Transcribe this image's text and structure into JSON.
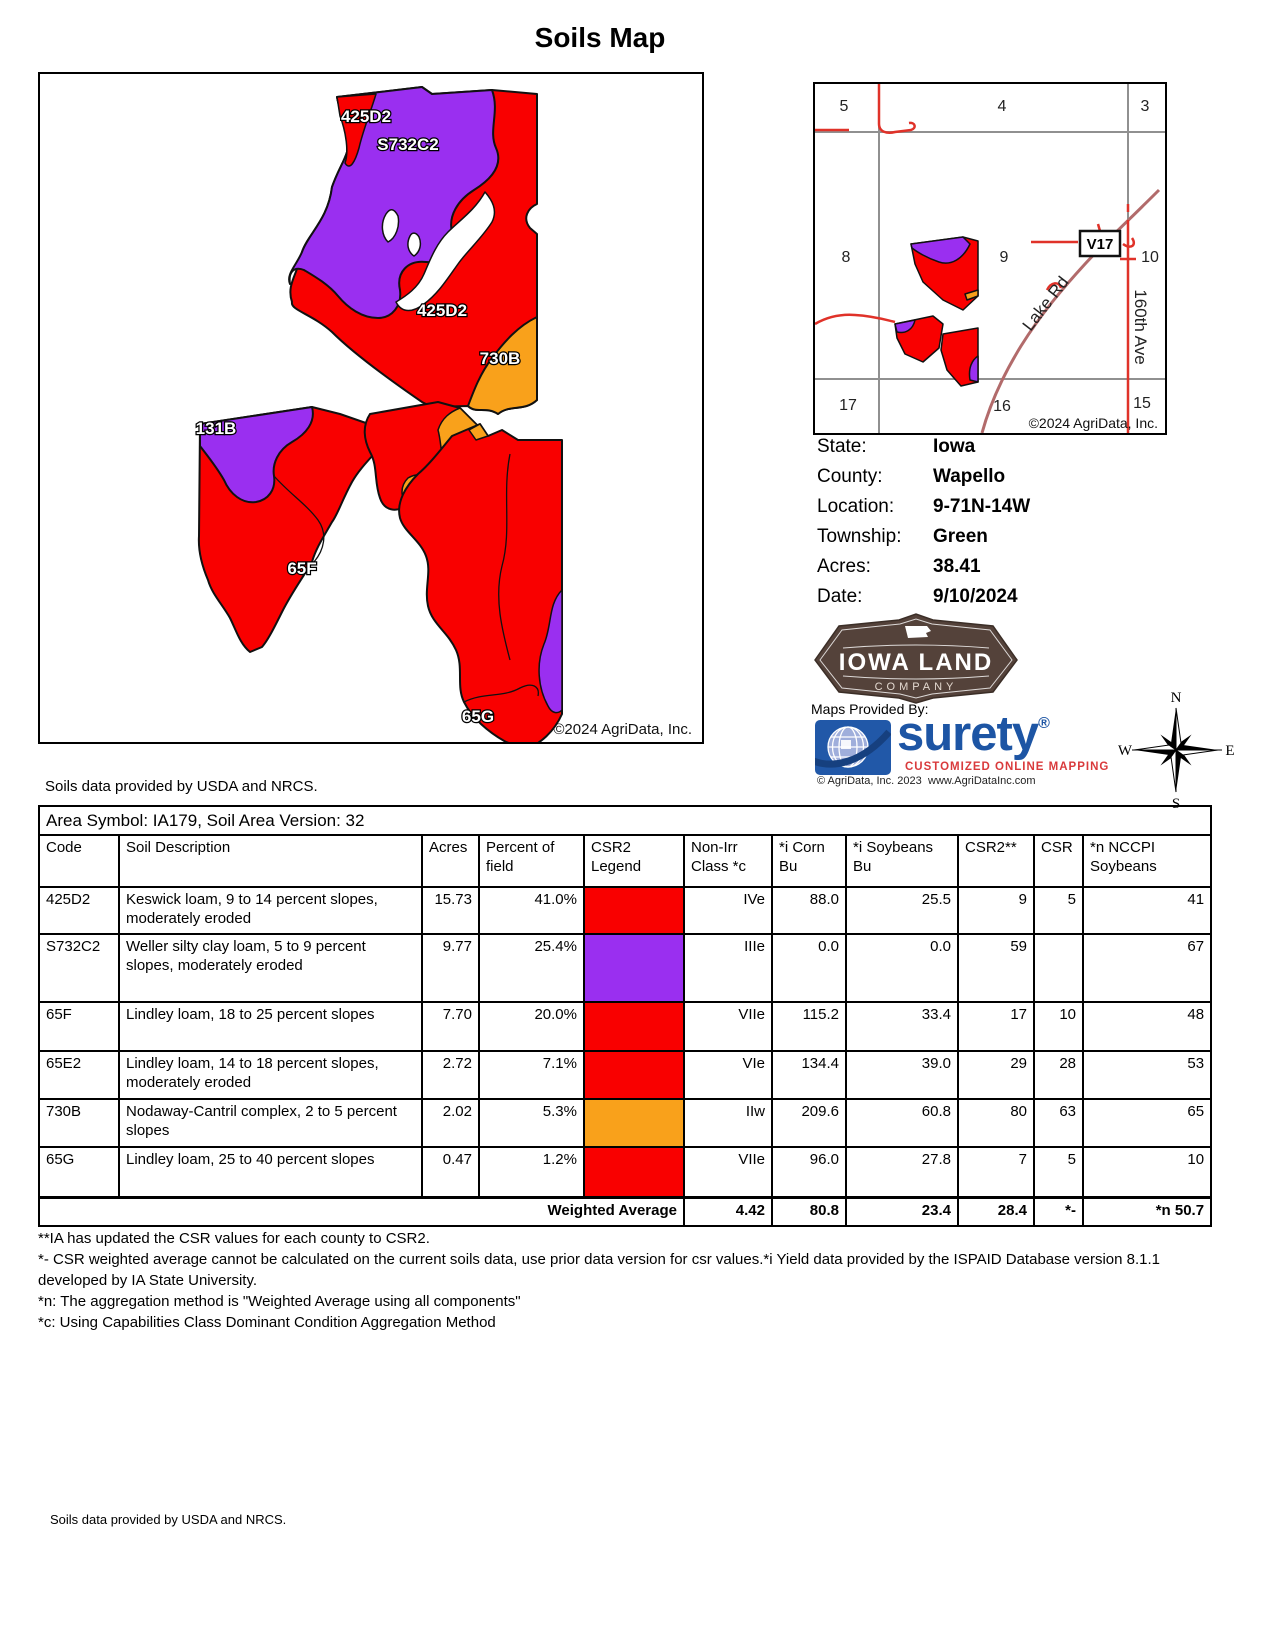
{
  "title": "Soils Map",
  "colors": {
    "soil_red": "#F90000",
    "soil_purple": "#9A2FF0",
    "soil_orange": "#F9A11B"
  },
  "map": {
    "labels": [
      "425D2",
      "S732C2",
      "425D2",
      "730B",
      "131B",
      "65F",
      "65G"
    ],
    "copyright": "©2024 AgriData, Inc.",
    "note": "Soils data provided by USDA and NRCS."
  },
  "locator": {
    "sections": [
      "5",
      "4",
      "3",
      "8",
      "9",
      "10",
      "17",
      "16",
      "15"
    ],
    "badge": "V17",
    "road_lake": "Lake Rd",
    "road_160th": "160th Ave",
    "copyright": "©2024 AgriData, Inc."
  },
  "info": {
    "rows": [
      {
        "label": "State:",
        "value": "Iowa"
      },
      {
        "label": "County:",
        "value": "Wapello"
      },
      {
        "label": "Location:",
        "value": "9-71N-14W"
      },
      {
        "label": "Township:",
        "value": "Green"
      },
      {
        "label": "Acres:",
        "value": "38.41"
      },
      {
        "label": "Date:",
        "value": "9/10/2024"
      }
    ]
  },
  "branding": {
    "iowa_land_line1": "IOWA LAND",
    "iowa_land_line2": "COMPANY",
    "provided_by": "Maps Provided By:",
    "surety": "surety",
    "surety_reg": "®",
    "surety_tagline": "CUSTOMIZED ONLINE MAPPING",
    "surety_copyright": "© AgriData, Inc. 2023",
    "surety_url": "www.AgriDataInc.com"
  },
  "compass": {
    "n": "N",
    "e": "E",
    "s": "S",
    "w": "W"
  },
  "table": {
    "area_title": "Area Symbol: IA179, Soil Area Version: 32",
    "headers": [
      "Code",
      "Soil Description",
      "Acres",
      "Percent of field",
      "CSR2 Legend",
      "Non-Irr Class *c",
      "*i Corn Bu",
      "*i Soybeans Bu",
      "CSR2**",
      "CSR",
      "*n NCCPI Soybeans"
    ],
    "rows": [
      {
        "code": "425D2",
        "desc": "Keswick loam, 9 to 14 percent slopes, moderately eroded",
        "acres": "15.73",
        "pct": "41.0%",
        "color": "#F90000",
        "cls": "IVe",
        "corn": "88.0",
        "soy": "25.5",
        "csr2": "9",
        "csr": "5",
        "nccpi": "41"
      },
      {
        "code": "S732C2",
        "desc": "Weller silty clay loam, 5 to 9 percent slopes, moderately eroded",
        "acres": "9.77",
        "pct": "25.4%",
        "color": "#9A2FF0",
        "cls": "IIIe",
        "corn": "0.0",
        "soy": "0.0",
        "csr2": "59",
        "csr": "",
        "nccpi": "67"
      },
      {
        "code": "65F",
        "desc": "Lindley loam, 18 to 25 percent slopes",
        "acres": "7.70",
        "pct": "20.0%",
        "color": "#F90000",
        "cls": "VIIe",
        "corn": "115.2",
        "soy": "33.4",
        "csr2": "17",
        "csr": "10",
        "nccpi": "48"
      },
      {
        "code": "65E2",
        "desc": "Lindley loam, 14 to 18 percent slopes, moderately eroded",
        "acres": "2.72",
        "pct": "7.1%",
        "color": "#F90000",
        "cls": "VIe",
        "corn": "134.4",
        "soy": "39.0",
        "csr2": "29",
        "csr": "28",
        "nccpi": "53"
      },
      {
        "code": "730B",
        "desc": "Nodaway-Cantril complex, 2 to 5 percent slopes",
        "acres": "2.02",
        "pct": "5.3%",
        "color": "#F9A11B",
        "cls": "IIw",
        "corn": "209.6",
        "soy": "60.8",
        "csr2": "80",
        "csr": "63",
        "nccpi": "65"
      },
      {
        "code": "65G",
        "desc": "Lindley loam, 25 to 40 percent slopes",
        "acres": "0.47",
        "pct": "1.2%",
        "color": "#F90000",
        "cls": "VIIe",
        "corn": "96.0",
        "soy": "27.8",
        "csr2": "7",
        "csr": "5",
        "nccpi": "10"
      }
    ],
    "weighted": {
      "label": "Weighted Average",
      "cls": "4.42",
      "corn": "80.8",
      "soy": "23.4",
      "csr2": "28.4",
      "csr": "*-",
      "nccpi": "*n 50.7"
    }
  },
  "footnotes": [
    "**IA has updated the CSR values for each county to CSR2.",
    "*- CSR weighted average cannot be calculated on the current soils data, use prior data version for csr values.*i Yield data provided by the ISPAID Database version 8.1.1 developed by IA State University.",
    "*n: The aggregation method is \"Weighted Average using all components\"",
    "*c: Using Capabilities Class Dominant Condition Aggregation Method"
  ],
  "bottom_note": "Soils data provided by USDA and NRCS."
}
